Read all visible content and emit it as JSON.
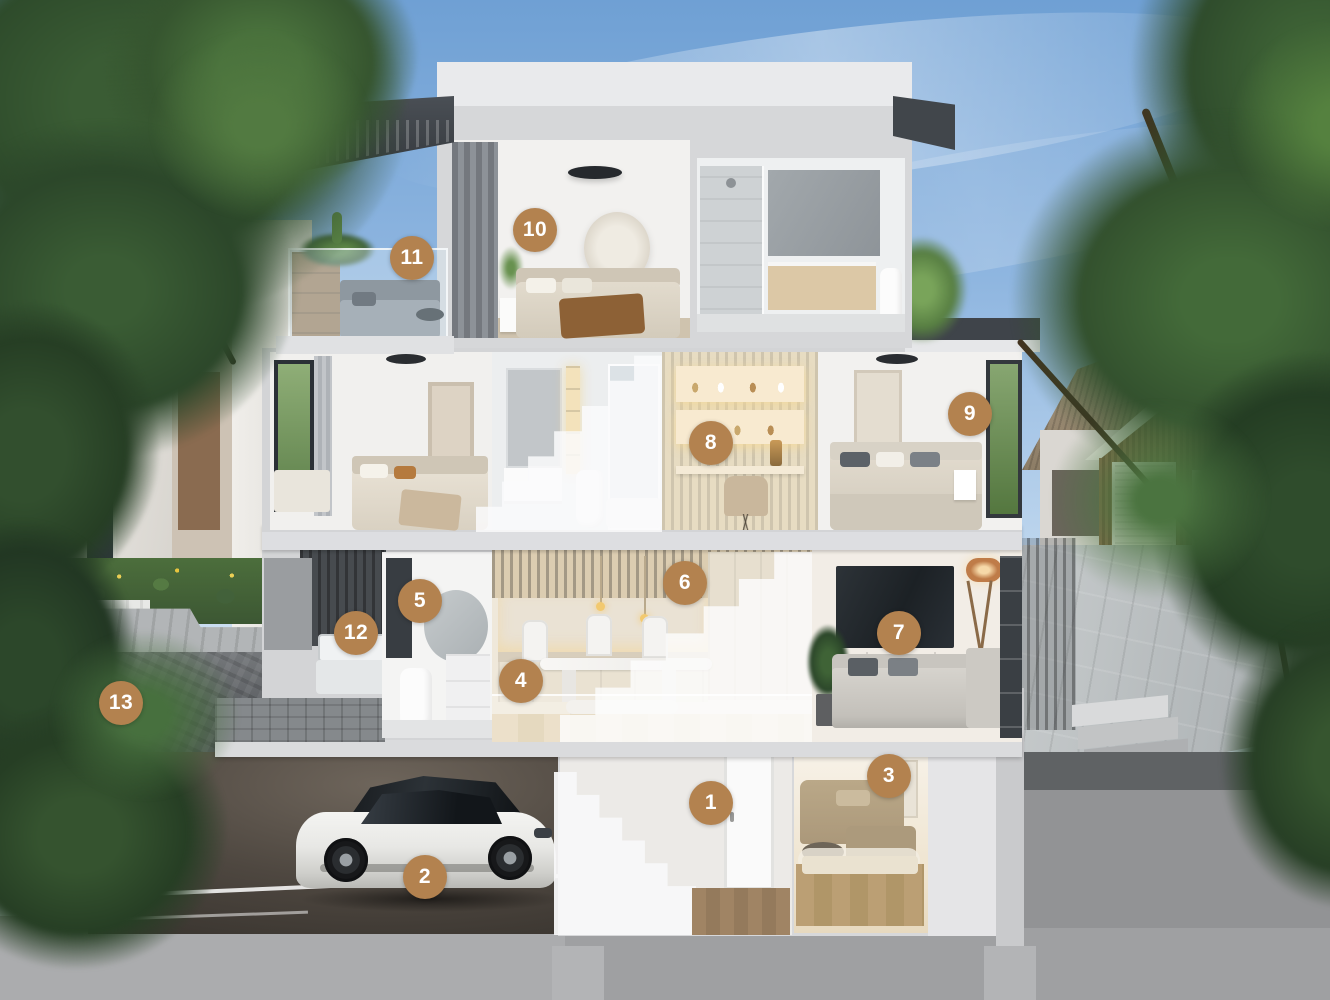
{
  "scene": {
    "kind": "architectural-cutaway-cross-section",
    "marker_count": 13
  },
  "markers": [
    {
      "n": "1",
      "x": 711,
      "y": 803
    },
    {
      "n": "2",
      "x": 425,
      "y": 877
    },
    {
      "n": "3",
      "x": 889,
      "y": 776
    },
    {
      "n": "4",
      "x": 521,
      "y": 681
    },
    {
      "n": "5",
      "x": 420,
      "y": 601
    },
    {
      "n": "6",
      "x": 685,
      "y": 583
    },
    {
      "n": "7",
      "x": 899,
      "y": 633
    },
    {
      "n": "8",
      "x": 711,
      "y": 443
    },
    {
      "n": "9",
      "x": 970,
      "y": 414
    },
    {
      "n": "10",
      "x": 535,
      "y": 230
    },
    {
      "n": "11",
      "x": 412,
      "y": 258
    },
    {
      "n": "12",
      "x": 356,
      "y": 633
    },
    {
      "n": "13",
      "x": 121,
      "y": 703
    }
  ],
  "colors": {
    "badge": "#b3824f",
    "badge_text": "#ffffff",
    "sky_top": "#6fa0d4",
    "sky_horizon": "#dde9f5",
    "cut_wall": "#d4d5d7",
    "roof_dark": "#41464c",
    "concrete_wall": "#5a5d61",
    "foliage_dark": "#2f4c2c",
    "warm_interior": "#efe8da"
  }
}
